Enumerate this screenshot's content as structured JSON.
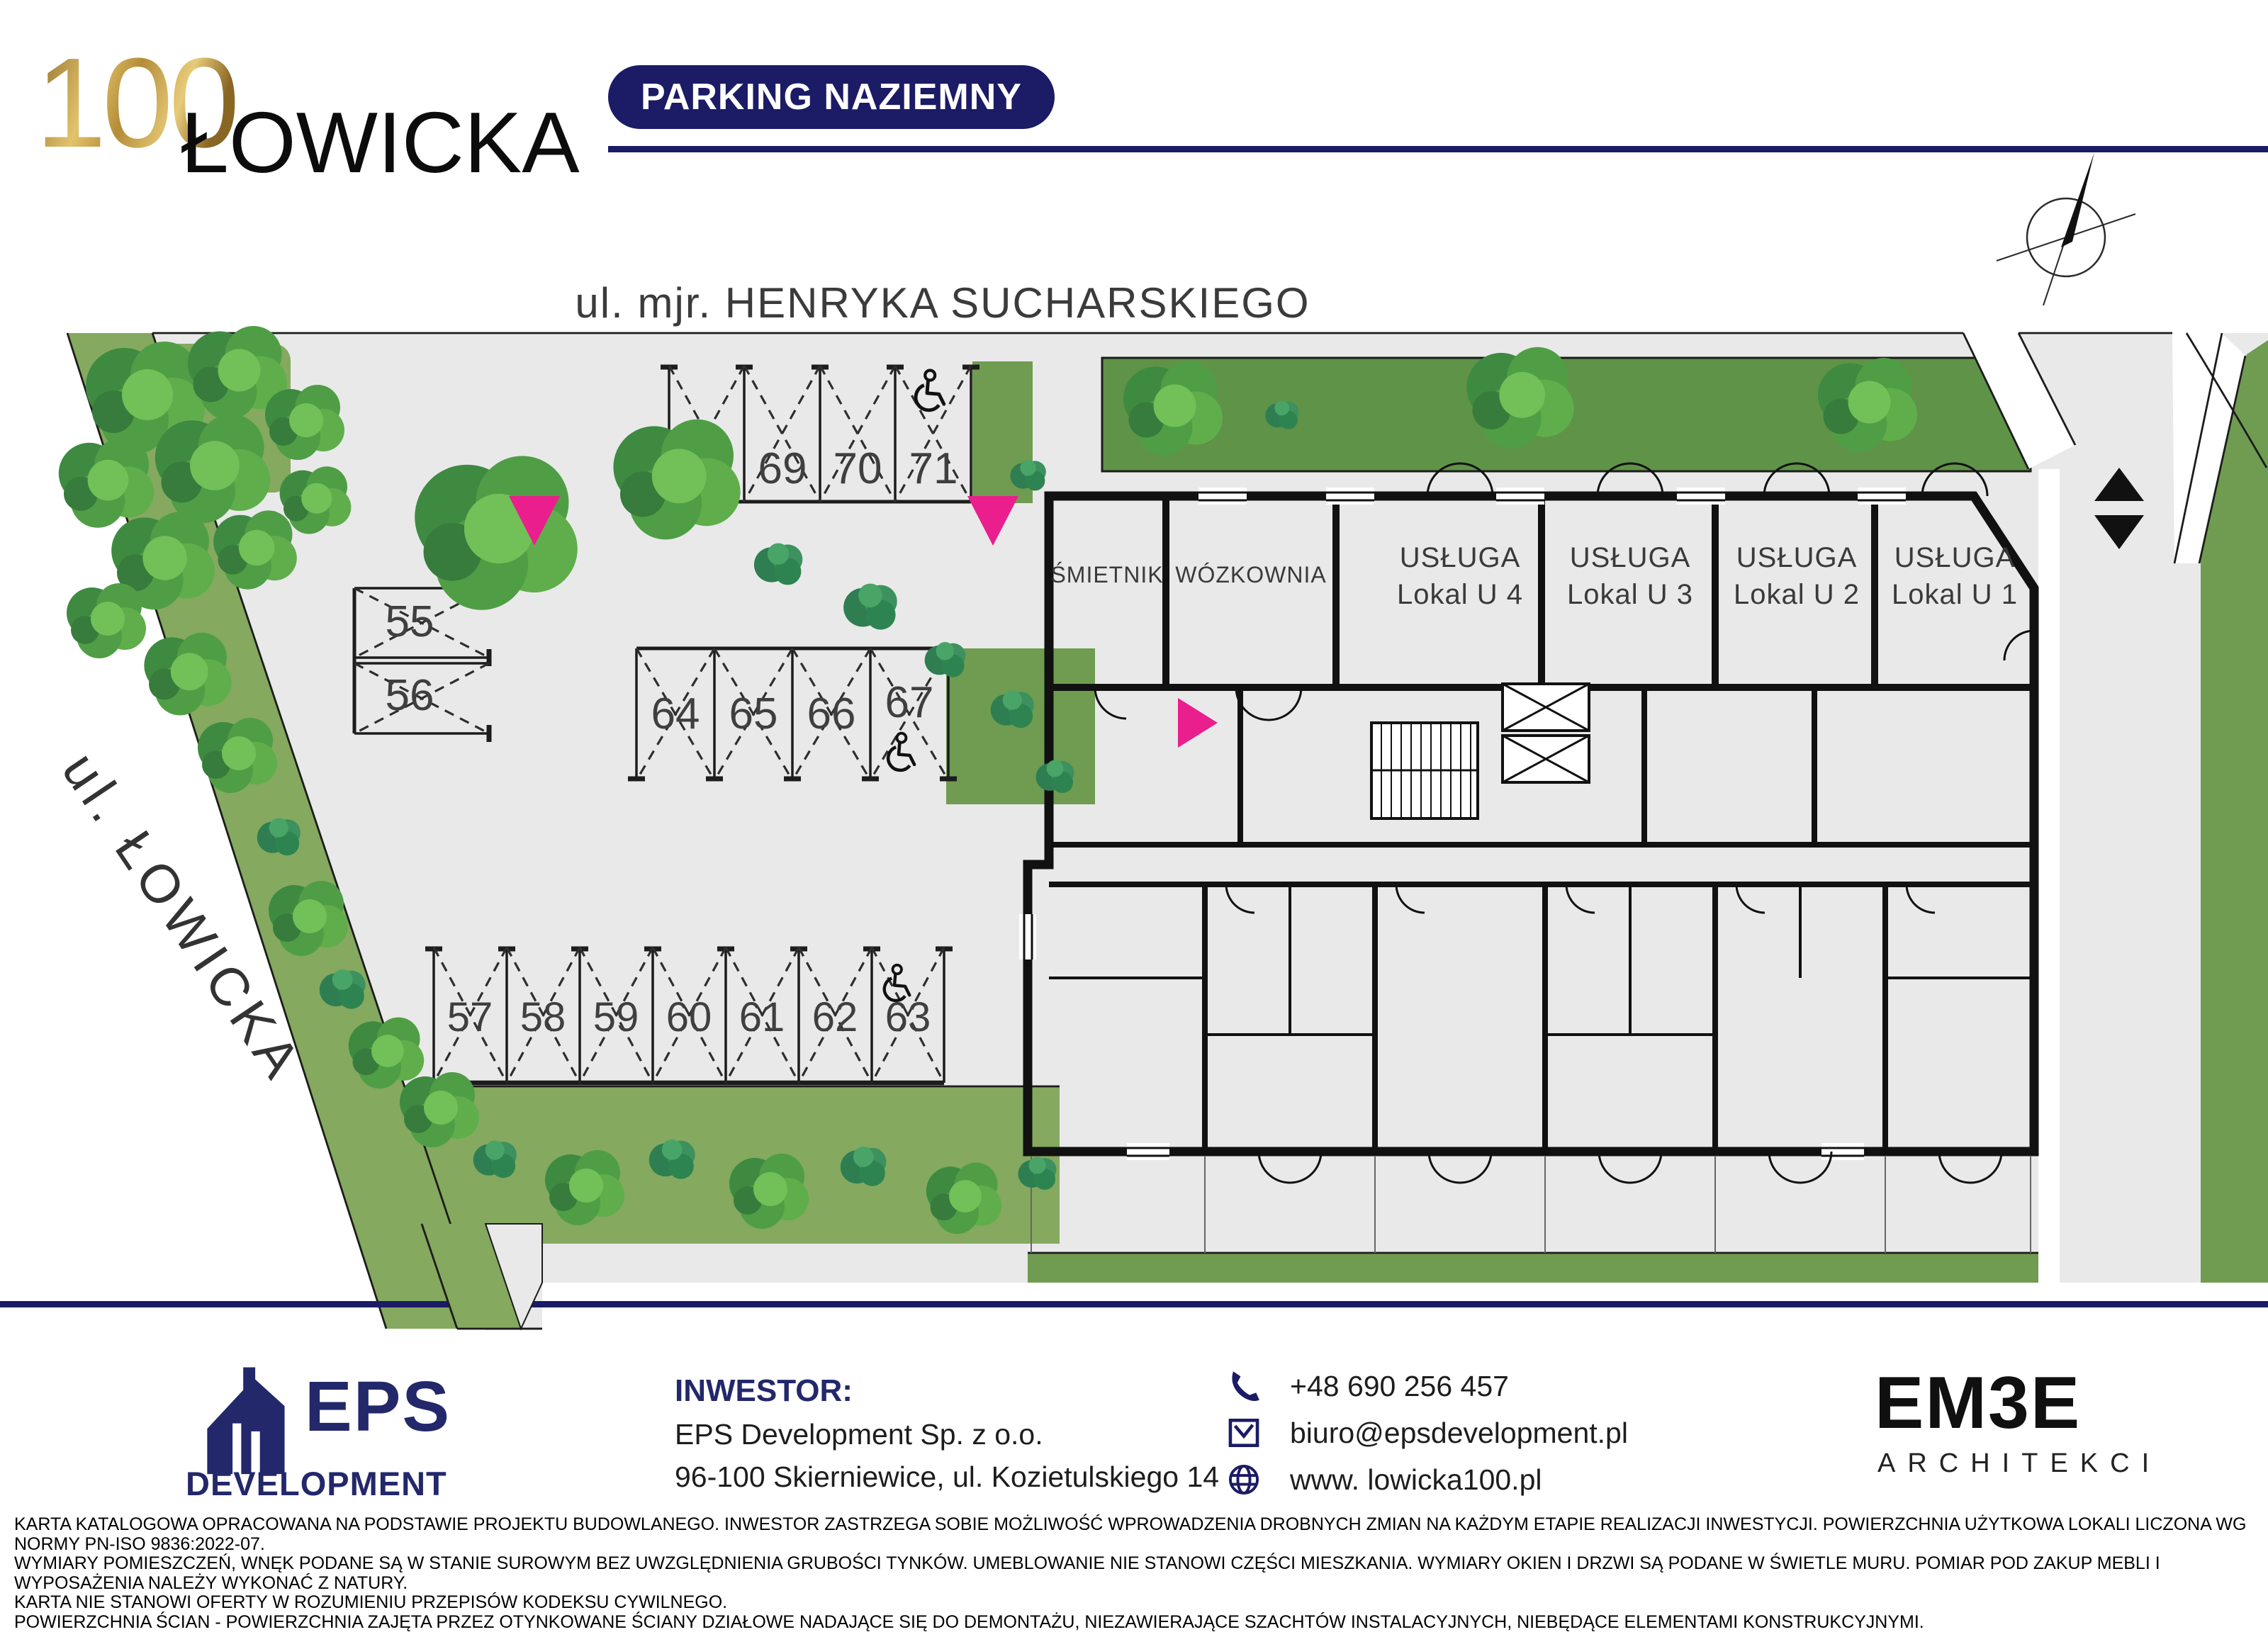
{
  "header": {
    "logo_num": "100",
    "logo_name": "ŁOWICKA",
    "badge": "PARKING NAZIEMNY"
  },
  "streets": {
    "top": "ul. mjr. HENRYKA SUCHARSKIEGO",
    "left": "ul. ŁOWICKA"
  },
  "building": {
    "smietnik": "ŚMIETNIK",
    "wozkownia": "WÓZKOWNIA",
    "usluga": "USŁUGA",
    "u4": "Lokal  U 4",
    "u3": "Lokal  U 3",
    "u2": "Lokal  U 2",
    "u1": "Lokal  U 1"
  },
  "parking": {
    "top_row": [
      "68",
      "69",
      "70",
      "71"
    ],
    "pair": [
      "55",
      "56"
    ],
    "mid_row": [
      "64",
      "65",
      "66",
      "67"
    ],
    "bottom_row": [
      "57",
      "58",
      "59",
      "60",
      "61",
      "62",
      "63"
    ]
  },
  "footer": {
    "inwestor_label": "INWESTOR:",
    "inwestor_name": "EPS Development Sp. z o.o.",
    "inwestor_addr": "96-100 Skierniewice, ul. Kozietulskiego 14",
    "phone": "+48 690 256 457",
    "email": "biuro@epsdevelopment.pl",
    "www": "www. lowicka100.pl",
    "eps_name": "EPS",
    "eps_sub": "DEVELOPMENT",
    "embe_name": "EM3E",
    "embe_sub": "ARCHITEKCI"
  },
  "legal": {
    "line1": "KARTA KATALOGOWA OPRACOWANA NA PODSTAWIE PROJEKTU BUDOWLANEGO. INWESTOR ZASTRZEGA SOBIE MOŻLIWOŚĆ WPROWADZENIA DROBNYCH ZMIAN NA KAŻDYM ETAPIE REALIZACJI INWESTYCJI. POWIERZCHNIA UŻYTKOWA LOKALI LICZONA WG NORMY PN-ISO 9836:2022-07.",
    "line2": "WYMIARY POMIESZCZEŃ, WNĘK PODANE SĄ W STANIE SUROWYM BEZ UWZGLĘDNIENIA GRUBOŚCI TYNKÓW. UMEBLOWANIE NIE STANOWI CZĘŚCI MIESZKANIA. WYMIARY OKIEN I DRZWI SĄ PODANE W ŚWIETLE MURU. POMIAR POD ZAKUP MEBLI I WYPOSAŻENIA NALEŻY WYKONAĆ Z NATURY.",
    "line3": "KARTA NIE STANOWI OFERTY W ROZUMIENIU PRZEPISÓW KODEKSU CYWILNEGO.",
    "line4": "POWIERZCHNIA ŚCIAN - POWIERZCHNIA ZAJĘTA PRZEZ OTYNKOWANE ŚCIANY DZIAŁOWE NADAJĄCE SIĘ DO DEMONTAŻU, NIEZAWIERAJĄCE SZACHTÓW INSTALACYJNYCH, NIEBĘDĄCE ELEMENTAMI KONSTRUKCYJNYMI."
  },
  "colors": {
    "navy": "#1b1b66",
    "gold": "#c9a04e",
    "magenta": "#ea1e8c",
    "site_gray": "#e9e9e9",
    "green": "#7ba25b"
  }
}
